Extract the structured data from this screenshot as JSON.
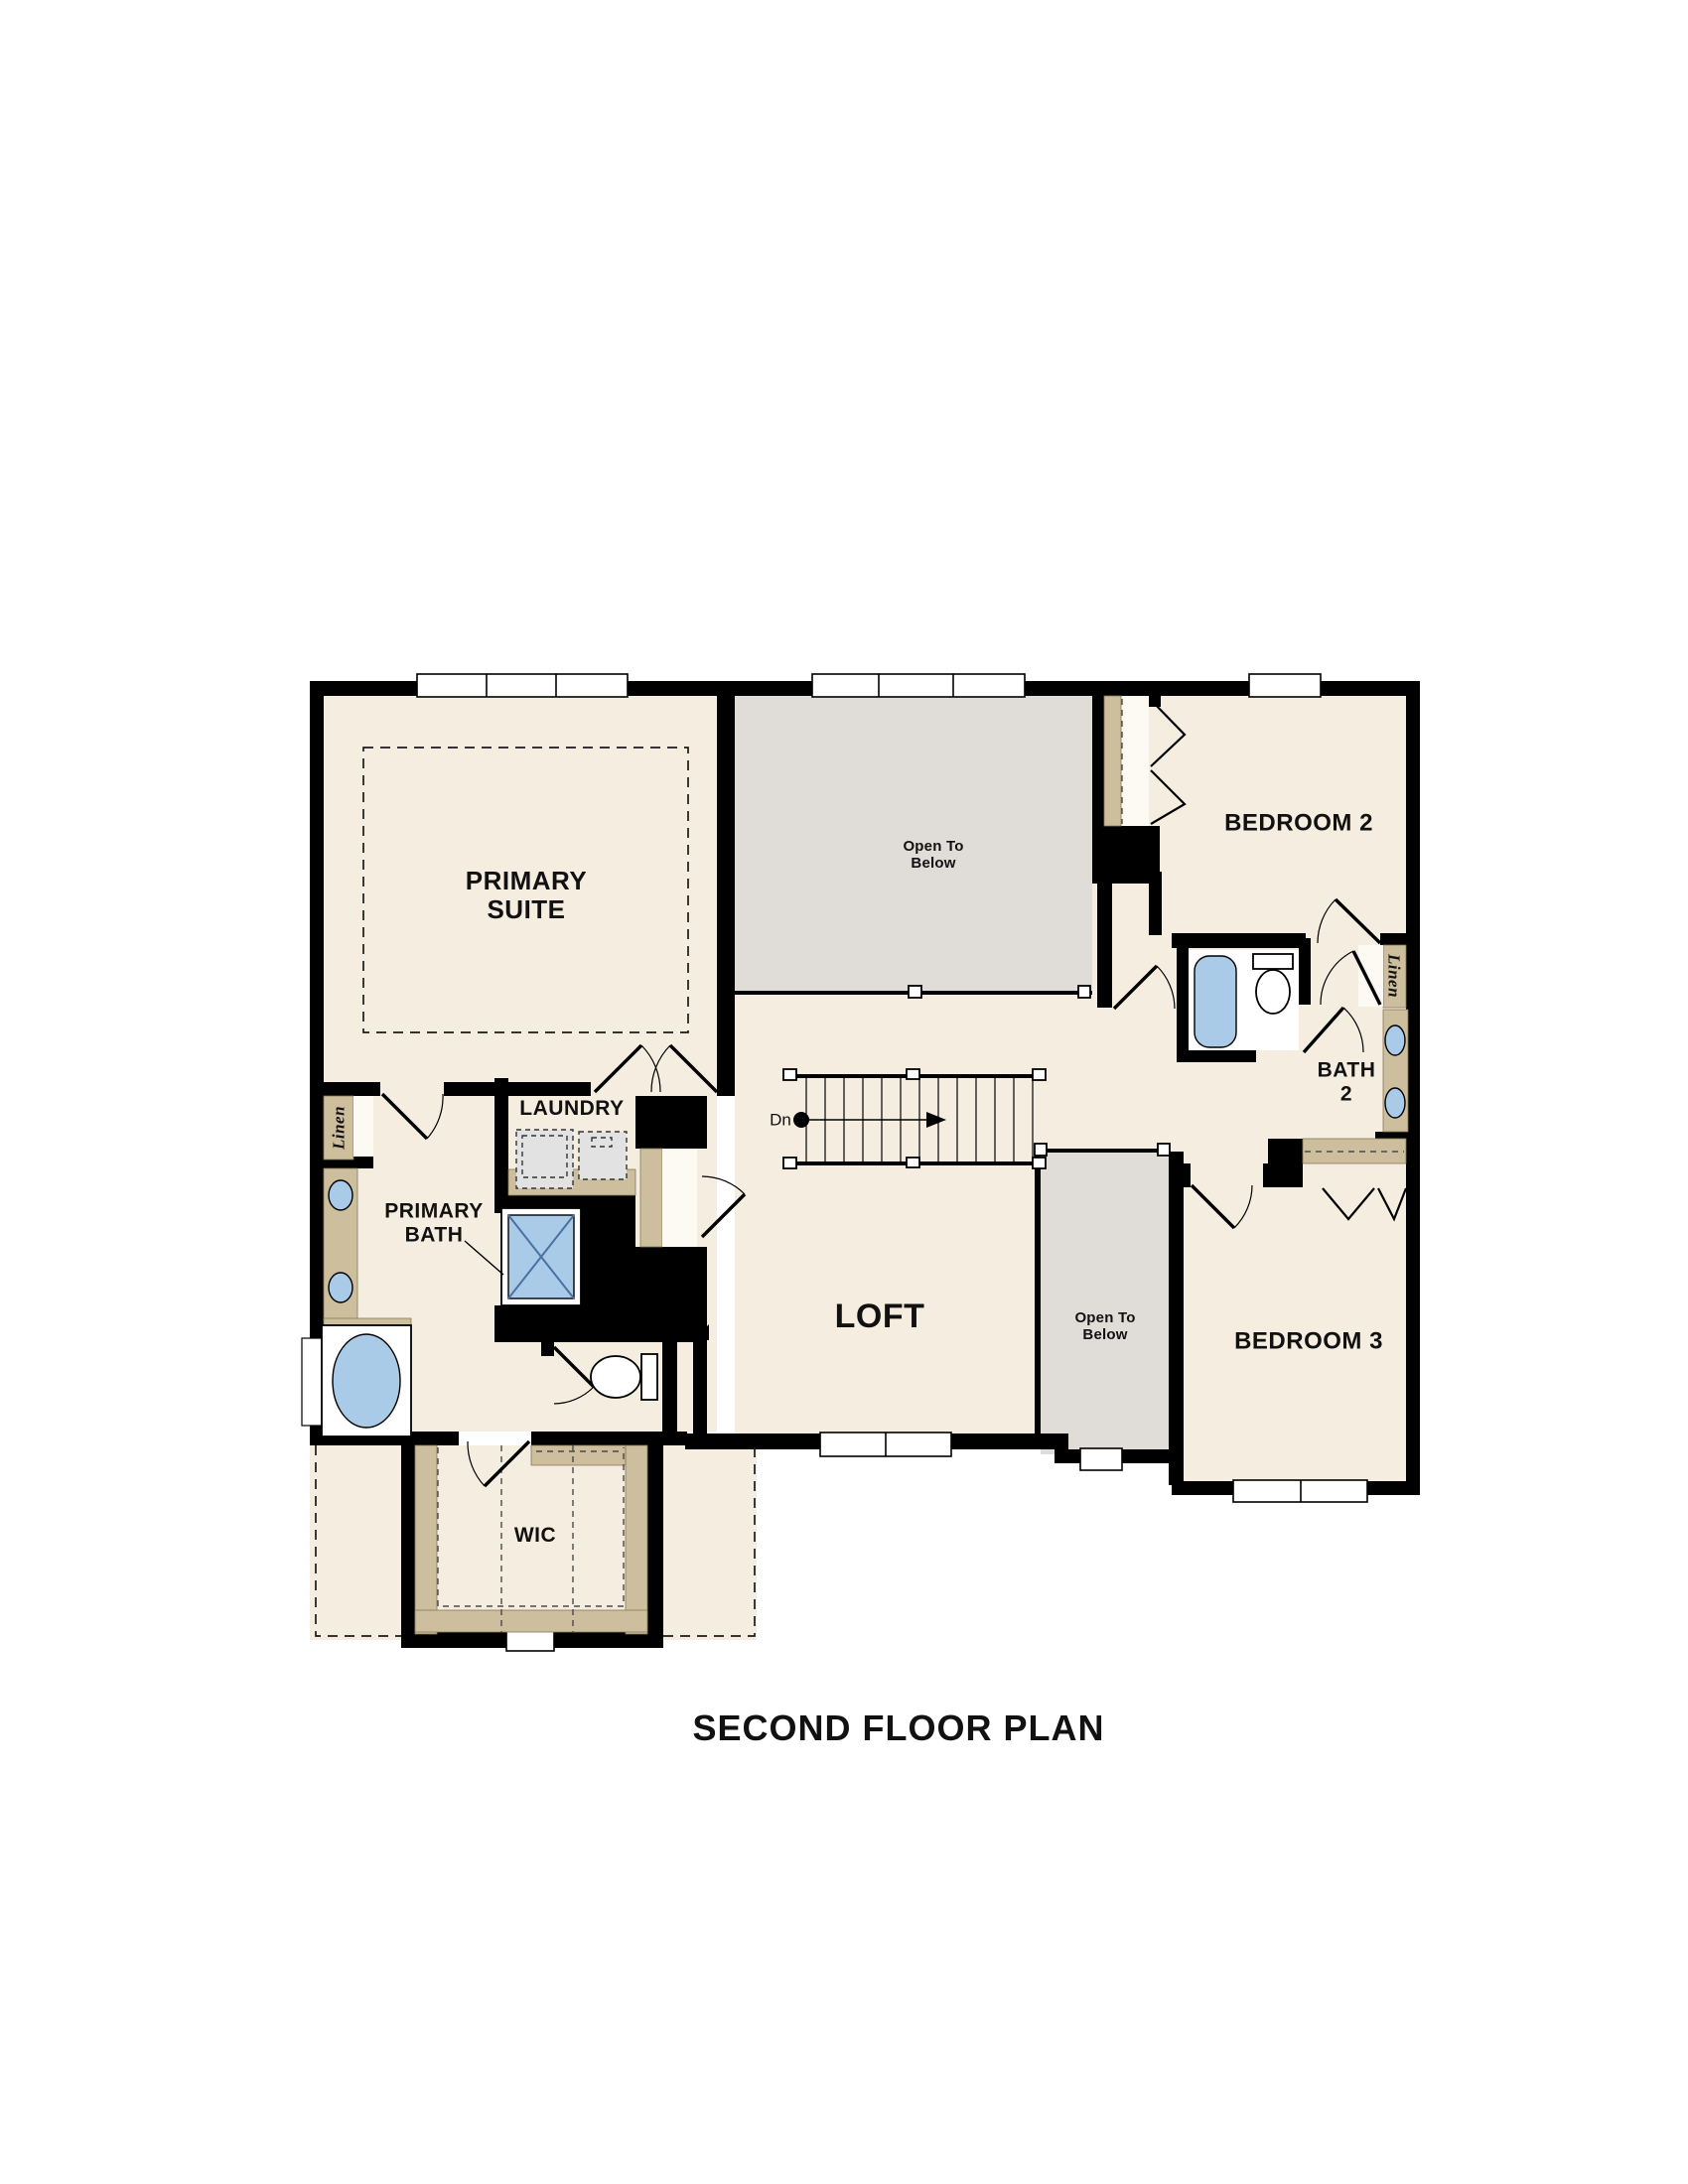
{
  "title": "SECOND FLOOR PLAN",
  "rooms": {
    "primary_suite": {
      "label": "PRIMARY SUITE"
    },
    "bedroom_2": {
      "label": "BEDROOM 2"
    },
    "bedroom_3": {
      "label": "BEDROOM 3"
    },
    "bath_2": {
      "label": "BATH 2"
    },
    "primary_bath": {
      "label": "PRIMARY BATH"
    },
    "laundry": {
      "label": "LAUNDRY"
    },
    "loft": {
      "label": "LOFT"
    },
    "wic": {
      "label": "WIC"
    }
  },
  "annotations": {
    "open_to_below": "Open To Below",
    "linen": "Linen",
    "stair_direction": "Dn"
  },
  "colors": {
    "floor": "#f5eee0",
    "open_below": "#e0ddd9",
    "wall": "#000000",
    "cabinet": "#cdbe9d",
    "fixture_blue": "#a9cbe8",
    "appliance": "#e2e2e2",
    "text": "#111111"
  }
}
